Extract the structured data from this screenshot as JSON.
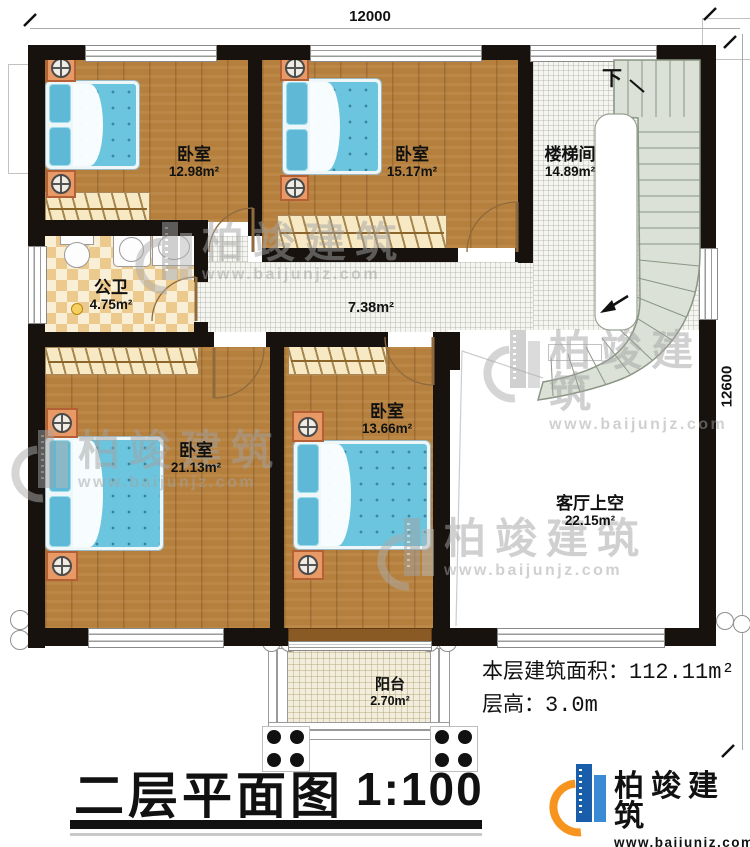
{
  "dimensions": {
    "top": "12000",
    "right": "12600"
  },
  "rooms": [
    {
      "id": "bedroom-top-left",
      "name": "卧室",
      "area": "12.98m²"
    },
    {
      "id": "bedroom-top-mid",
      "name": "卧室",
      "area": "15.17m²"
    },
    {
      "id": "stairwell",
      "name": "楼梯间",
      "area": "14.89m²",
      "down_label": "下"
    },
    {
      "id": "bathroom",
      "name": "公卫",
      "area": "4.75m²"
    },
    {
      "id": "hallway",
      "name": "",
      "area": "7.38m²"
    },
    {
      "id": "bedroom-bottom-left",
      "name": "卧室",
      "area": "21.13m²"
    },
    {
      "id": "bedroom-bottom-mid",
      "name": "卧室",
      "area": "13.66m²"
    },
    {
      "id": "living-void",
      "name": "客厅上空",
      "area": "22.15m²"
    },
    {
      "id": "balcony",
      "name": "阳台",
      "area": "2.70m²"
    }
  ],
  "info": {
    "floor_area_label": "本层建筑面积：",
    "floor_area_value": "112.11m²",
    "height_label": "层高：",
    "height_value": "3.0m"
  },
  "titleblock": {
    "plan_title": "二层平面图",
    "scale": "1:100"
  },
  "brand": {
    "name": "柏竣建筑",
    "url": "www.baijunjz.com",
    "blue": "#1a5dab",
    "orange": "#f7941e"
  },
  "watermark": {
    "text": "柏竣建筑",
    "url": "www.baijunjz.com"
  }
}
